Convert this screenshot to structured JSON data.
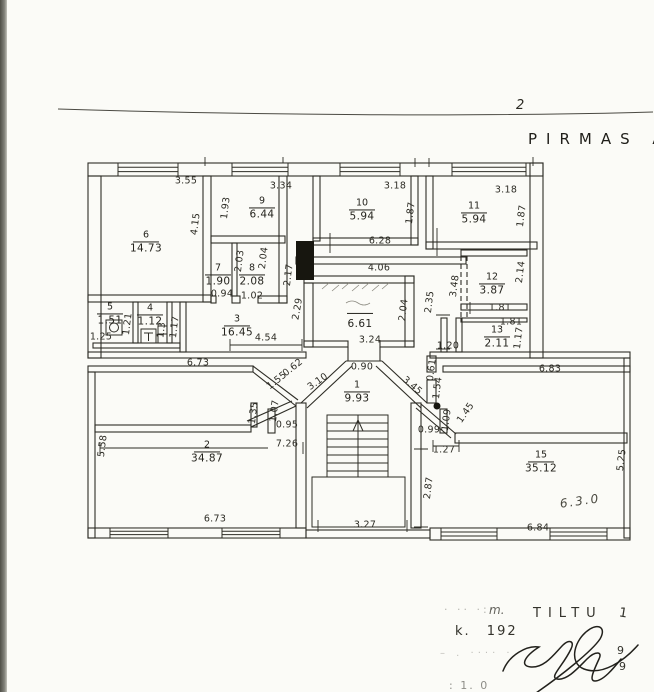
{
  "page": {
    "number": "2",
    "title": "PIRMAS A"
  },
  "colors": {
    "ink": "#2b2a23",
    "scan_edge": "#5a5a52",
    "paper": "#fbfbf7"
  },
  "plan": {
    "rooms": [
      {
        "num": "6",
        "area": "14.73",
        "x": 146,
        "y": 239
      },
      {
        "num": "9",
        "area": "6.44",
        "x": 262,
        "y": 205
      },
      {
        "num": "10",
        "area": "5.94",
        "x": 362,
        "y": 207
      },
      {
        "num": "11",
        "area": "5.94",
        "x": 474,
        "y": 210
      },
      {
        "num": "7",
        "area": "1.90",
        "x": 218,
        "y": 272
      },
      {
        "num": "8",
        "area": "2.08",
        "x": 252,
        "y": 272
      },
      {
        "num": "12",
        "area": "3.87",
        "x": 492,
        "y": 281
      },
      {
        "num": "13",
        "area": "2.11",
        "x": 497,
        "y": 334
      },
      {
        "num": "5",
        "area": "1.51",
        "x": 110,
        "y": 311
      },
      {
        "num": "4",
        "area": "1.12",
        "x": 150,
        "y": 312
      },
      {
        "num": "3",
        "area": "16.45",
        "x": 237,
        "y": 323
      },
      {
        "num": "",
        "area": "6.61",
        "x": 360,
        "y": 315
      },
      {
        "num": "1",
        "area": "9.93",
        "x": 357,
        "y": 389
      },
      {
        "num": "2",
        "area": "34.87",
        "x": 207,
        "y": 449
      },
      {
        "num": "15",
        "area": "35.12",
        "x": 541,
        "y": 459
      }
    ],
    "dimensions": [
      {
        "v": "3.55",
        "x": 186,
        "y": 181,
        "r": 0
      },
      {
        "v": "4.15",
        "x": 196,
        "y": 224,
        "r": -83
      },
      {
        "v": "3.34",
        "x": 281,
        "y": 186,
        "r": 0
      },
      {
        "v": "1.93",
        "x": 226,
        "y": 208,
        "r": -83
      },
      {
        "v": "3.18",
        "x": 395,
        "y": 186,
        "r": 0
      },
      {
        "v": "1.87",
        "x": 411,
        "y": 213,
        "r": -83
      },
      {
        "v": "3.18",
        "x": 506,
        "y": 190,
        "r": 0
      },
      {
        "v": "1.87",
        "x": 522,
        "y": 216,
        "r": -83
      },
      {
        "v": "6.28",
        "x": 380,
        "y": 241,
        "r": 0
      },
      {
        "v": "4.06",
        "x": 379,
        "y": 268,
        "r": 0
      },
      {
        "v": "2.03",
        "x": 240,
        "y": 261,
        "r": -83
      },
      {
        "v": "2.04",
        "x": 264,
        "y": 258,
        "r": -83
      },
      {
        "v": "0.94",
        "x": 222,
        "y": 294,
        "r": 0
      },
      {
        "v": "1.02",
        "x": 252,
        "y": 296,
        "r": 0
      },
      {
        "v": "2.17",
        "x": 289,
        "y": 275,
        "r": -83
      },
      {
        "v": "2.29",
        "x": 298,
        "y": 309,
        "r": -80
      },
      {
        "v": "2.04",
        "x": 404,
        "y": 310,
        "r": -83
      },
      {
        "v": "3.24",
        "x": 370,
        "y": 340,
        "r": 0
      },
      {
        "v": "2.35",
        "x": 430,
        "y": 302,
        "r": -83
      },
      {
        "v": "3.48",
        "x": 455,
        "y": 286,
        "r": -83
      },
      {
        "v": "2.14",
        "x": 521,
        "y": 272,
        "r": -83
      },
      {
        "v": "1.81",
        "x": 500,
        "y": 308,
        "r": 0
      },
      {
        "v": "1.81",
        "x": 511,
        "y": 322,
        "r": 0
      },
      {
        "v": "1.17",
        "x": 519,
        "y": 338,
        "r": -83
      },
      {
        "v": "1.20",
        "x": 448,
        "y": 346,
        "r": 0
      },
      {
        "v": "0.61",
        "x": 432,
        "y": 370,
        "r": -83
      },
      {
        "v": "1.54",
        "x": 438,
        "y": 388,
        "r": -83
      },
      {
        "v": "6.83",
        "x": 550,
        "y": 369,
        "r": 0
      },
      {
        "v": "1.25",
        "x": 101,
        "y": 337,
        "r": 0
      },
      {
        "v": "1.21",
        "x": 128,
        "y": 324,
        "r": -83
      },
      {
        "v": "1.3",
        "x": 162,
        "y": 330,
        "r": -83
      },
      {
        "v": "1.17",
        "x": 175,
        "y": 327,
        "r": -83
      },
      {
        "v": "4.54",
        "x": 266,
        "y": 338,
        "r": 0
      },
      {
        "v": "6.73",
        "x": 198,
        "y": 363,
        "r": 0
      },
      {
        "v": "1.55",
        "x": 277,
        "y": 381,
        "r": -38
      },
      {
        "v": "0.62",
        "x": 293,
        "y": 368,
        "r": -38
      },
      {
        "v": "0.90",
        "x": 362,
        "y": 367,
        "r": 0
      },
      {
        "v": "3.10",
        "x": 318,
        "y": 382,
        "r": -35
      },
      {
        "v": "3.45",
        "x": 412,
        "y": 386,
        "r": 40
      },
      {
        "v": "1.07",
        "x": 275,
        "y": 411,
        "r": -83
      },
      {
        "v": "0.95",
        "x": 287,
        "y": 425,
        "r": 0
      },
      {
        "v": "7.26",
        "x": 287,
        "y": 444,
        "r": 0
      },
      {
        "v": "1.35",
        "x": 254,
        "y": 413,
        "r": -83
      },
      {
        "v": "0.99",
        "x": 429,
        "y": 430,
        "r": 0
      },
      {
        "v": "1.09",
        "x": 447,
        "y": 420,
        "r": -83
      },
      {
        "v": "1.45",
        "x": 466,
        "y": 413,
        "r": -55
      },
      {
        "v": "1.27",
        "x": 444,
        "y": 450,
        "r": 0
      },
      {
        "v": "2.87",
        "x": 429,
        "y": 488,
        "r": -83
      },
      {
        "v": "3.27",
        "x": 365,
        "y": 525,
        "r": 0
      },
      {
        "v": "5.58",
        "x": 103,
        "y": 446,
        "r": -83
      },
      {
        "v": "6.73",
        "x": 215,
        "y": 519,
        "r": 0
      },
      {
        "v": "6.84",
        "x": 538,
        "y": 528,
        "r": 0
      },
      {
        "v": "5.25",
        "x": 622,
        "y": 460,
        "r": -83
      }
    ],
    "annotations": [
      {
        "v": "6.3.0",
        "x": 580,
        "y": 501,
        "r": -8
      }
    ]
  },
  "footer": {
    "faint1": "· ·· ·:·",
    "m_label": "m.",
    "street": "TILTU",
    "street_no": "1",
    "house": "k.  192",
    "digit1": "9",
    "digit2": "9",
    "faint2": "– . ···· ·",
    "scale_note": ": 1. 0"
  }
}
